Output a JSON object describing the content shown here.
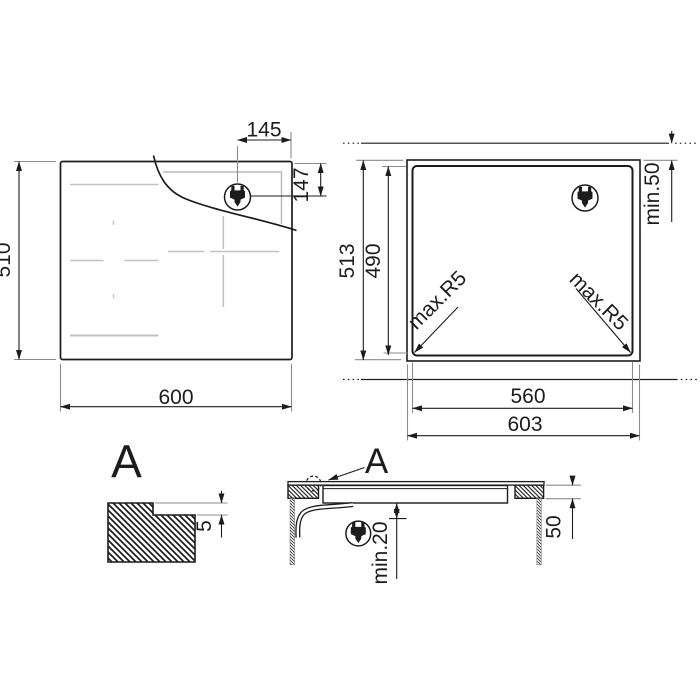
{
  "drawing": {
    "top_view": {
      "width": "600",
      "height": "510",
      "plug_offset_x": "145",
      "plug_offset_y": "147"
    },
    "cutout_view": {
      "overall_width": "603",
      "overall_height": "513",
      "cutout_width": "560",
      "cutout_height": "490",
      "top_clearance": "min.50",
      "corner_radius_left": "max.R5",
      "corner_radius_right": "max.R5"
    },
    "detail_view": {
      "label": "A",
      "rebate_depth": "5"
    },
    "section_view": {
      "detail_ref": "A",
      "bottom_clearance": "min.20",
      "worktop_thickness": "50"
    }
  },
  "icons": {
    "plug": "power-plug-icon"
  },
  "colors": {
    "line": "#1c1c1c",
    "extension": "#8c8c8c",
    "zone_marking": "#c2c2c2",
    "background": "#ffffff"
  }
}
